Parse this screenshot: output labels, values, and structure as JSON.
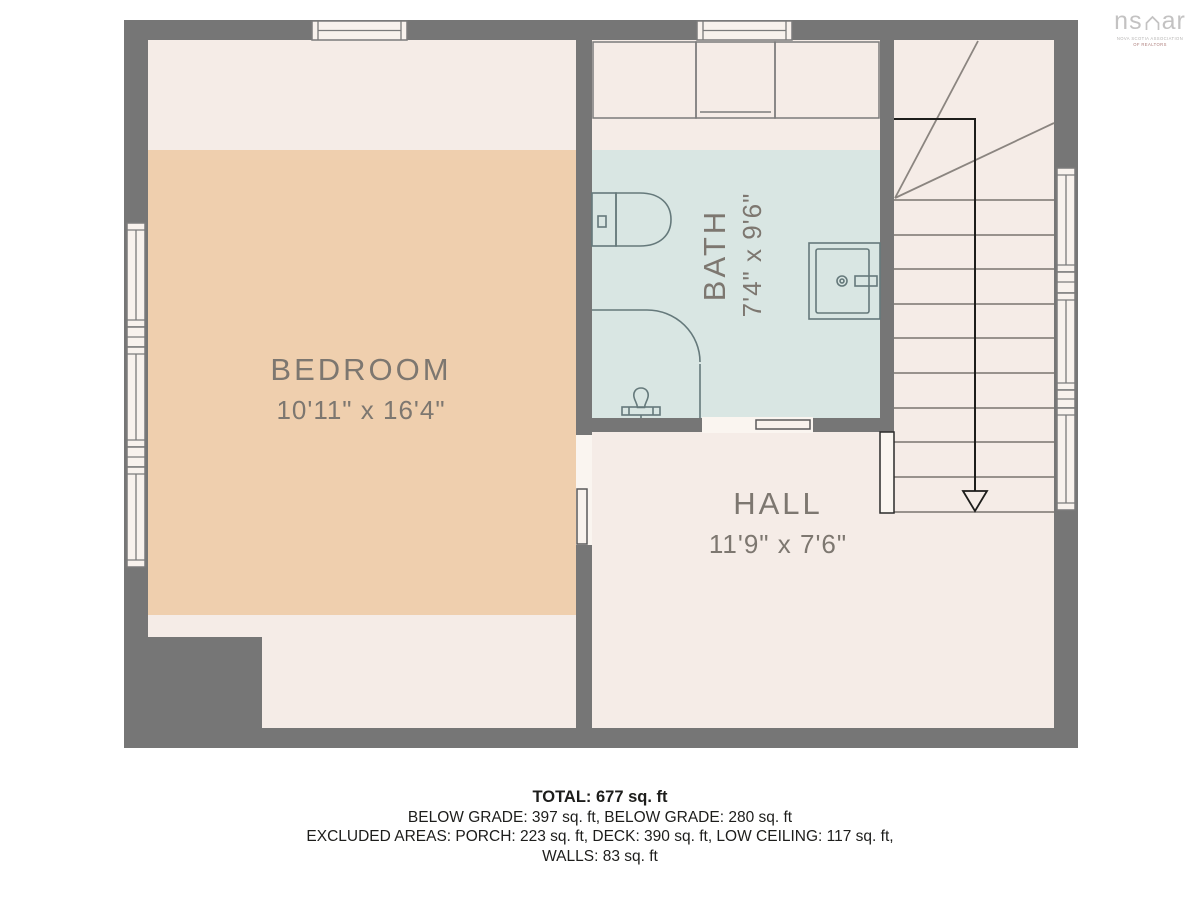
{
  "logo": {
    "text_left": "ns",
    "text_right": "ar",
    "tagline_line1": "NOVA SCOTIA ASSOCIATION",
    "tagline_line2": "OF REALTORS"
  },
  "rooms": {
    "bedroom": {
      "label": "BEDROOM",
      "dimensions": "10'11\" x 16'4\""
    },
    "bath": {
      "label": "BATH",
      "dimensions": "7'4\" x 9'6\""
    },
    "hall": {
      "label": "HALL",
      "dimensions": "11'9\" x 7'6\""
    }
  },
  "summary": {
    "total": "TOTAL: 677 sq. ft",
    "grades": "BELOW GRADE: 397 sq. ft, BELOW GRADE: 280 sq. ft",
    "excluded": "EXCLUDED AREAS: PORCH: 223 sq. ft, DECK: 390 sq. ft, LOW CEILING: 117 sq. ft,",
    "walls": "WALLS: 83 sq. ft"
  },
  "colors": {
    "wall": "#767676",
    "floor": "#f5ece7",
    "bedroom_floor": "#efcfae",
    "bath_floor": "#d9e6e3",
    "fixture_line": "#65797b",
    "stair_line": "#8b8580",
    "label_text": "#7d7770",
    "ink": "#1d1d1b"
  }
}
